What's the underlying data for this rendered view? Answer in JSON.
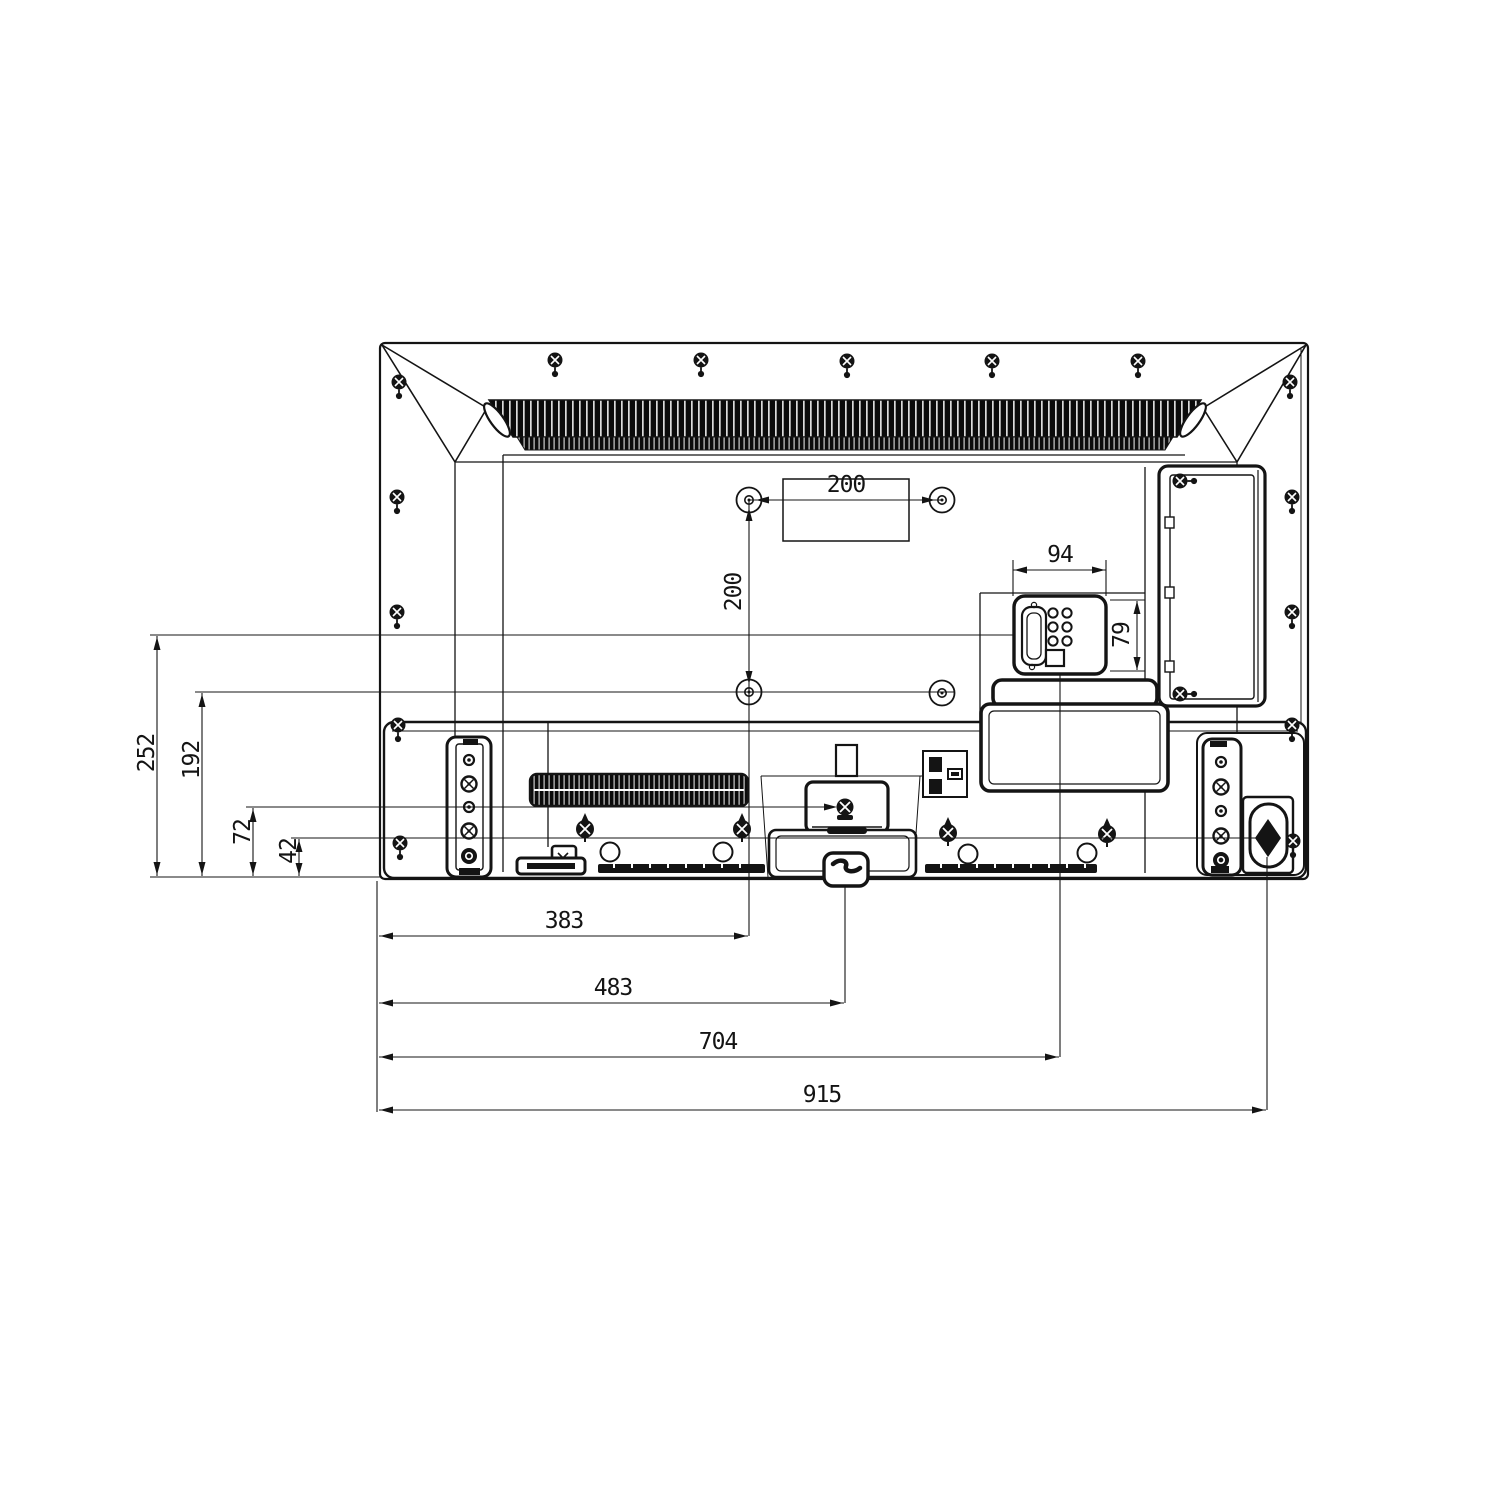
{
  "drawing": {
    "type": "tv-rear-dimension-drawing",
    "ink_color": "#141414",
    "background": "#ffffff",
    "dims": {
      "d200h": "200",
      "d200v": "200",
      "d94": "94",
      "d79": "79",
      "d252": "252",
      "d192": "192",
      "d72": "72",
      "d42": "42",
      "d383": "383",
      "d483": "483",
      "d704": "704",
      "d915": "915"
    }
  }
}
